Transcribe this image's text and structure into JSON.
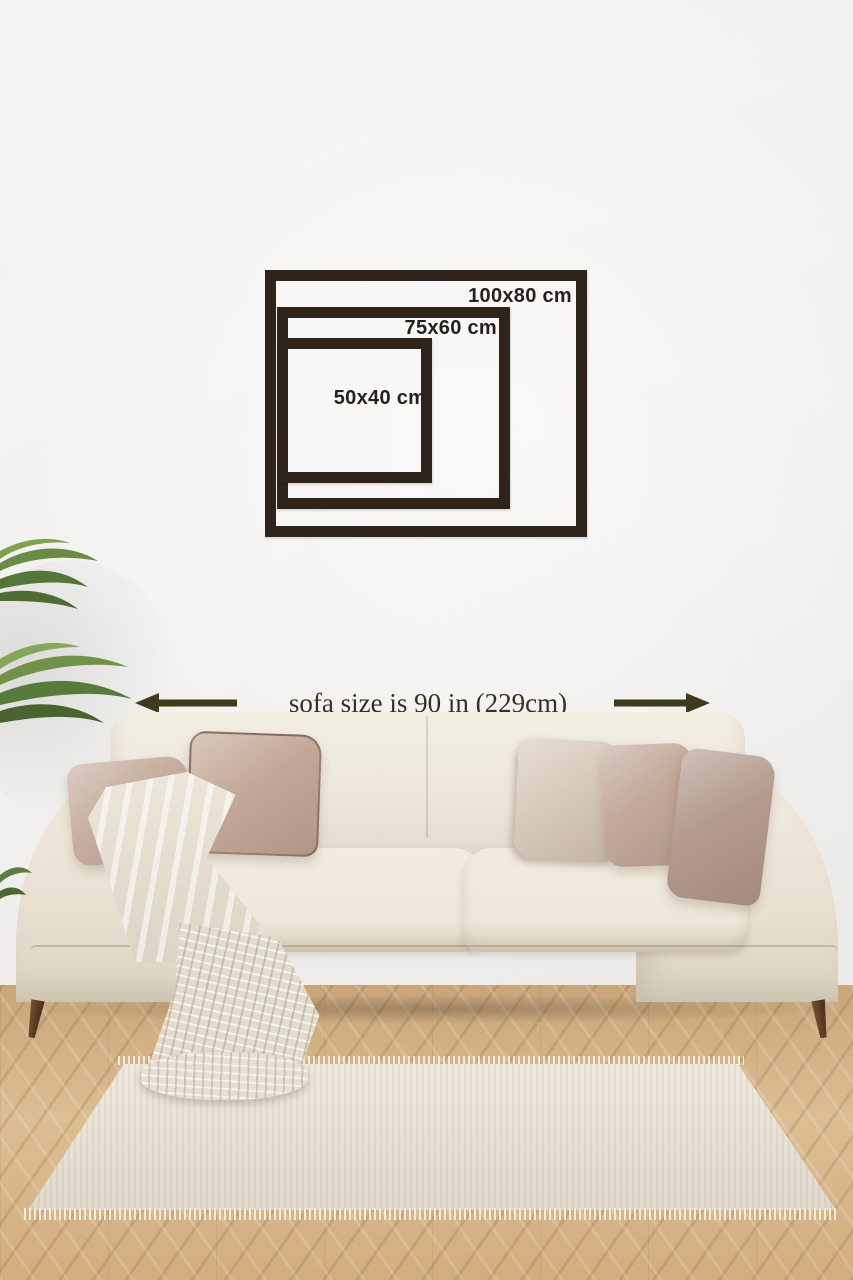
{
  "size_guide": {
    "frames": [
      {
        "label": "100x80 cm"
      },
      {
        "label": "75x60 cm"
      },
      {
        "label": "50x40 cm"
      }
    ]
  },
  "sofa_dimension": {
    "text": "sofa size is 90 in (229cm)",
    "arrow_left": "left-arrow",
    "arrow_right": "right-arrow"
  },
  "colors": {
    "frame": "#2e241b",
    "label": "#25211e",
    "arrow": "#3e3b1c",
    "dimtext": "#35311f",
    "wall": "#f1f0ee",
    "rug": "#e8e2d6",
    "throw": "#e8e2d5",
    "p1": "#c6ad9f",
    "p2": "#c4a897",
    "p3": "#d8cabb",
    "p4": "#c2a99a",
    "p5": "#b49b8d",
    "floor_light": "#dcbe93",
    "floor_dark": "#c9a578",
    "leg": "#5a3c26",
    "plant_green": "#6b8c46"
  }
}
